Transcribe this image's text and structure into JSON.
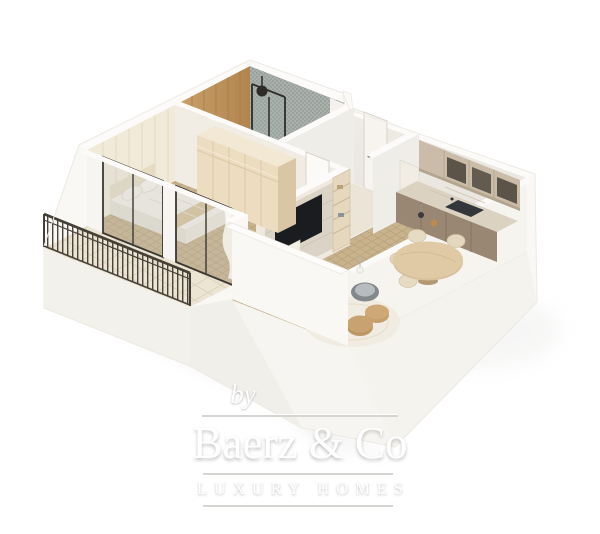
{
  "watermark": {
    "prefix": "by",
    "brand": "Baerz & Co",
    "tagline": "LUXURY HOMES"
  },
  "scene": {
    "type": "3d-isometric-floorplan-render",
    "description": "Cutaway 3D floor plan of a one-bedroom apartment with balcony, white walls and tan mosaic floors",
    "rooms": [
      {
        "name": "bathroom",
        "position": "top-left",
        "features": [
          "gray mosaic tiled walls",
          "walk-in shower with black-framed glass",
          "black round shower head",
          "wood accent wall with shelf niches",
          "white vanity with basin",
          "toilet",
          "white shelf niche"
        ]
      },
      {
        "name": "hallway",
        "position": "top-center",
        "features": [
          "entrance door",
          "door to bedroom",
          "small white cabinet"
        ]
      },
      {
        "name": "kitchen",
        "position": "top-right",
        "features": [
          "upper cabinets with dark open shelving",
          "marble countertop",
          "dark undermount sink",
          "taupe base cabinets",
          "tall light cabinet",
          "two pendant lights"
        ]
      },
      {
        "name": "living-dining",
        "position": "right",
        "features": [
          "round wooden dining table with pedestal",
          "four cream chairs",
          "gray round lounge chair",
          "floor lamp with white globe",
          "round cream rug",
          "two tan poufs",
          "stone media wall with TV",
          "beige shelving unit",
          "low white cabinet"
        ]
      },
      {
        "name": "bedroom",
        "position": "left",
        "features": [
          "double bed with beige bedding and pillows",
          "tan throw blanket",
          "cream paneled wardrobe with upper cabinets",
          "wall paneling",
          "two dark-framed sliding glass doors",
          "sheer curtain"
        ]
      },
      {
        "name": "balcony",
        "position": "bottom-left",
        "features": [
          "pale large-tile floor",
          "dark metal railing with vertical balusters",
          "white parapet wall piers"
        ]
      }
    ]
  },
  "palette": {
    "background": "#ffffff",
    "wall_white": "#f8f6f3",
    "wall_shade": "#efece6",
    "floor_tan": "#c9b38d",
    "floor_grout": "#b39d76",
    "balcony_tile": "#ece5d3",
    "bath_mosaic": "#a7aeaa",
    "wood_accent": "#c2985f",
    "wardrobe_cream": "#ead9bc",
    "kitchen_upper": "#cabca8",
    "kitchen_shelf_dark": "#5c5349",
    "kitchen_counter": "#d9cfc0",
    "kitchen_base": "#9a8773",
    "sink_dark": "#34383d",
    "table_wood": "#d8c09a",
    "chair_cream": "#e7dbc3",
    "pouf_tan": "#c59e6e",
    "rug_cream": "#f0ebdf",
    "tv_black": "#1a1c1f",
    "glass_frame": "#3b3733",
    "railing_dark": "#46403a",
    "watermark_text": "#ffffff",
    "watermark_line": "#d6d4d1"
  }
}
